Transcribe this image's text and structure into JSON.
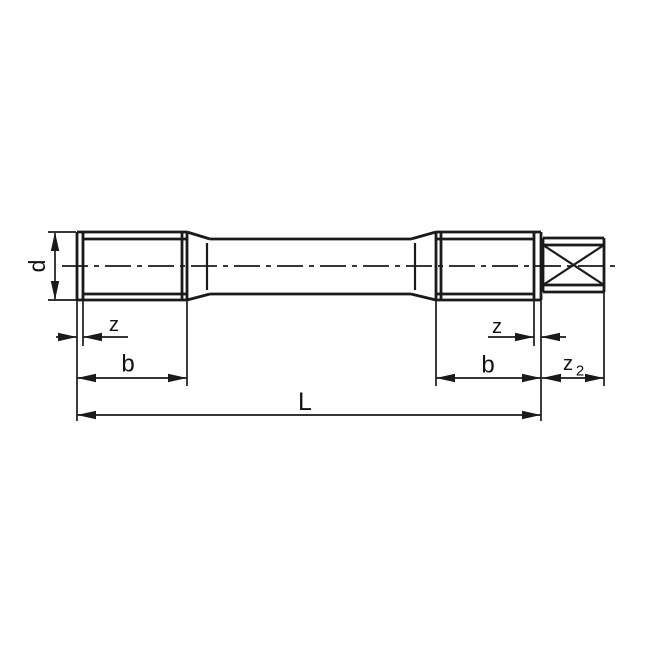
{
  "drawing": {
    "type": "technical-drawing",
    "description": "Dimensioned side view of a double-ended threaded stud (tap blank) with square drive end",
    "background": "#ffffff",
    "line_color": "#1a1a1a",
    "labels": {
      "d": "d",
      "z_left": "z",
      "b_left": "b",
      "length": "L",
      "z_right": "z",
      "b_right": "b",
      "z2": "z",
      "z2_sub": "2"
    },
    "geometry": {
      "canvas": {
        "w": 647,
        "h": 647
      },
      "centerline": {
        "x1": 62,
        "y1": 266,
        "x2": 617,
        "y2": 266,
        "dash": "26 6 5 6"
      },
      "part_lines": [
        [
          77,
          232,
          187,
          232
        ],
        [
          77,
          300,
          187,
          300
        ],
        [
          77,
          232,
          77,
          300
        ],
        [
          83,
          232,
          83,
          300
        ],
        [
          182,
          232,
          182,
          300
        ],
        [
          187,
          232,
          187,
          300
        ],
        [
          83,
          239,
          187,
          239
        ],
        [
          83,
          294,
          187,
          294
        ],
        [
          187,
          232,
          210,
          239
        ],
        [
          187,
          300,
          210,
          294
        ],
        [
          210,
          239,
          411,
          239
        ],
        [
          210,
          294,
          411,
          294
        ],
        [
          411,
          239,
          436,
          232
        ],
        [
          411,
          294,
          436,
          300
        ],
        [
          436,
          232,
          541,
          232
        ],
        [
          436,
          300,
          541,
          300
        ],
        [
          436,
          232,
          436,
          300
        ],
        [
          441,
          232,
          441,
          300
        ],
        [
          534,
          232,
          534,
          300
        ],
        [
          541,
          232,
          541,
          300
        ],
        [
          436,
          239,
          534,
          239
        ],
        [
          436,
          294,
          534,
          294
        ],
        [
          543,
          238,
          604,
          238
        ],
        [
          543,
          292,
          604,
          292
        ],
        [
          543,
          245,
          604,
          245
        ],
        [
          543,
          285,
          604,
          285
        ],
        [
          543,
          238,
          543,
          292
        ],
        [
          604,
          238,
          604,
          292
        ]
      ],
      "medium_lines": [
        [
          207,
          243,
          207,
          290
        ],
        [
          415,
          243,
          415,
          290
        ],
        [
          543,
          245,
          604,
          285
        ],
        [
          543,
          285,
          604,
          245
        ]
      ],
      "extension_lines": [
        [
          77,
          300,
          77,
          421
        ],
        [
          83,
          300,
          83,
          346
        ],
        [
          187,
          300,
          187,
          386
        ],
        [
          436,
          300,
          436,
          386
        ],
        [
          534,
          300,
          534,
          346
        ],
        [
          541,
          300,
          541,
          421
        ],
        [
          604,
          292,
          604,
          386
        ],
        [
          48,
          232,
          76,
          232
        ],
        [
          48,
          300,
          97,
          300
        ]
      ],
      "dimension_lines": [
        [
          55,
          233,
          55,
          299
        ],
        [
          56,
          337,
          77,
          337
        ],
        [
          83,
          337,
          128,
          337
        ],
        [
          77,
          378,
          187,
          378
        ],
        [
          77,
          415,
          541,
          415
        ],
        [
          488,
          337,
          534,
          337
        ],
        [
          541,
          337,
          566,
          337
        ],
        [
          436,
          378,
          541,
          378
        ],
        [
          542,
          378,
          604,
          378
        ]
      ],
      "arrows": [
        {
          "x": 55,
          "y": 232,
          "dir": "up"
        },
        {
          "x": 55,
          "y": 300,
          "dir": "down"
        },
        {
          "x": 77,
          "y": 337,
          "dir": "right"
        },
        {
          "x": 83,
          "y": 337,
          "dir": "left"
        },
        {
          "x": 77,
          "y": 378,
          "dir": "left"
        },
        {
          "x": 187,
          "y": 378,
          "dir": "right"
        },
        {
          "x": 77,
          "y": 415,
          "dir": "left"
        },
        {
          "x": 541,
          "y": 415,
          "dir": "right"
        },
        {
          "x": 534,
          "y": 337,
          "dir": "right"
        },
        {
          "x": 541,
          "y": 337,
          "dir": "left"
        },
        {
          "x": 436,
          "y": 378,
          "dir": "left"
        },
        {
          "x": 541,
          "y": 378,
          "dir": "right"
        },
        {
          "x": 542,
          "y": 378,
          "dir": "left"
        },
        {
          "x": 604,
          "y": 378,
          "dir": "right"
        }
      ],
      "labels": [
        {
          "key": "d",
          "x": 37,
          "y": 266,
          "size": 23,
          "rotate": -90,
          "name": "dim-label-d"
        },
        {
          "key": "z_left",
          "x": 114,
          "y": 325,
          "size": 20,
          "name": "dim-label-z-left"
        },
        {
          "key": "b_left",
          "x": 128,
          "y": 364,
          "size": 24,
          "name": "dim-label-b-left"
        },
        {
          "key": "length",
          "x": 305,
          "y": 402,
          "size": 25,
          "name": "dim-label-L"
        },
        {
          "key": "z_right",
          "x": 497,
          "y": 327,
          "size": 20,
          "name": "dim-label-z-right"
        },
        {
          "key": "b_right",
          "x": 488,
          "y": 365,
          "size": 24,
          "name": "dim-label-b-right"
        },
        {
          "key": "z2",
          "x": 568,
          "y": 364,
          "size": 20,
          "name": "dim-label-z2"
        },
        {
          "key": "z2_sub",
          "x": 580,
          "y": 371,
          "size": 15,
          "name": "dim-label-z2-subscript"
        }
      ],
      "stroke_widths": {
        "part": 2.8,
        "medium": 2.2,
        "thin": 1.7
      },
      "arrow_size": {
        "length": 19,
        "half_width": 4.2
      }
    }
  }
}
